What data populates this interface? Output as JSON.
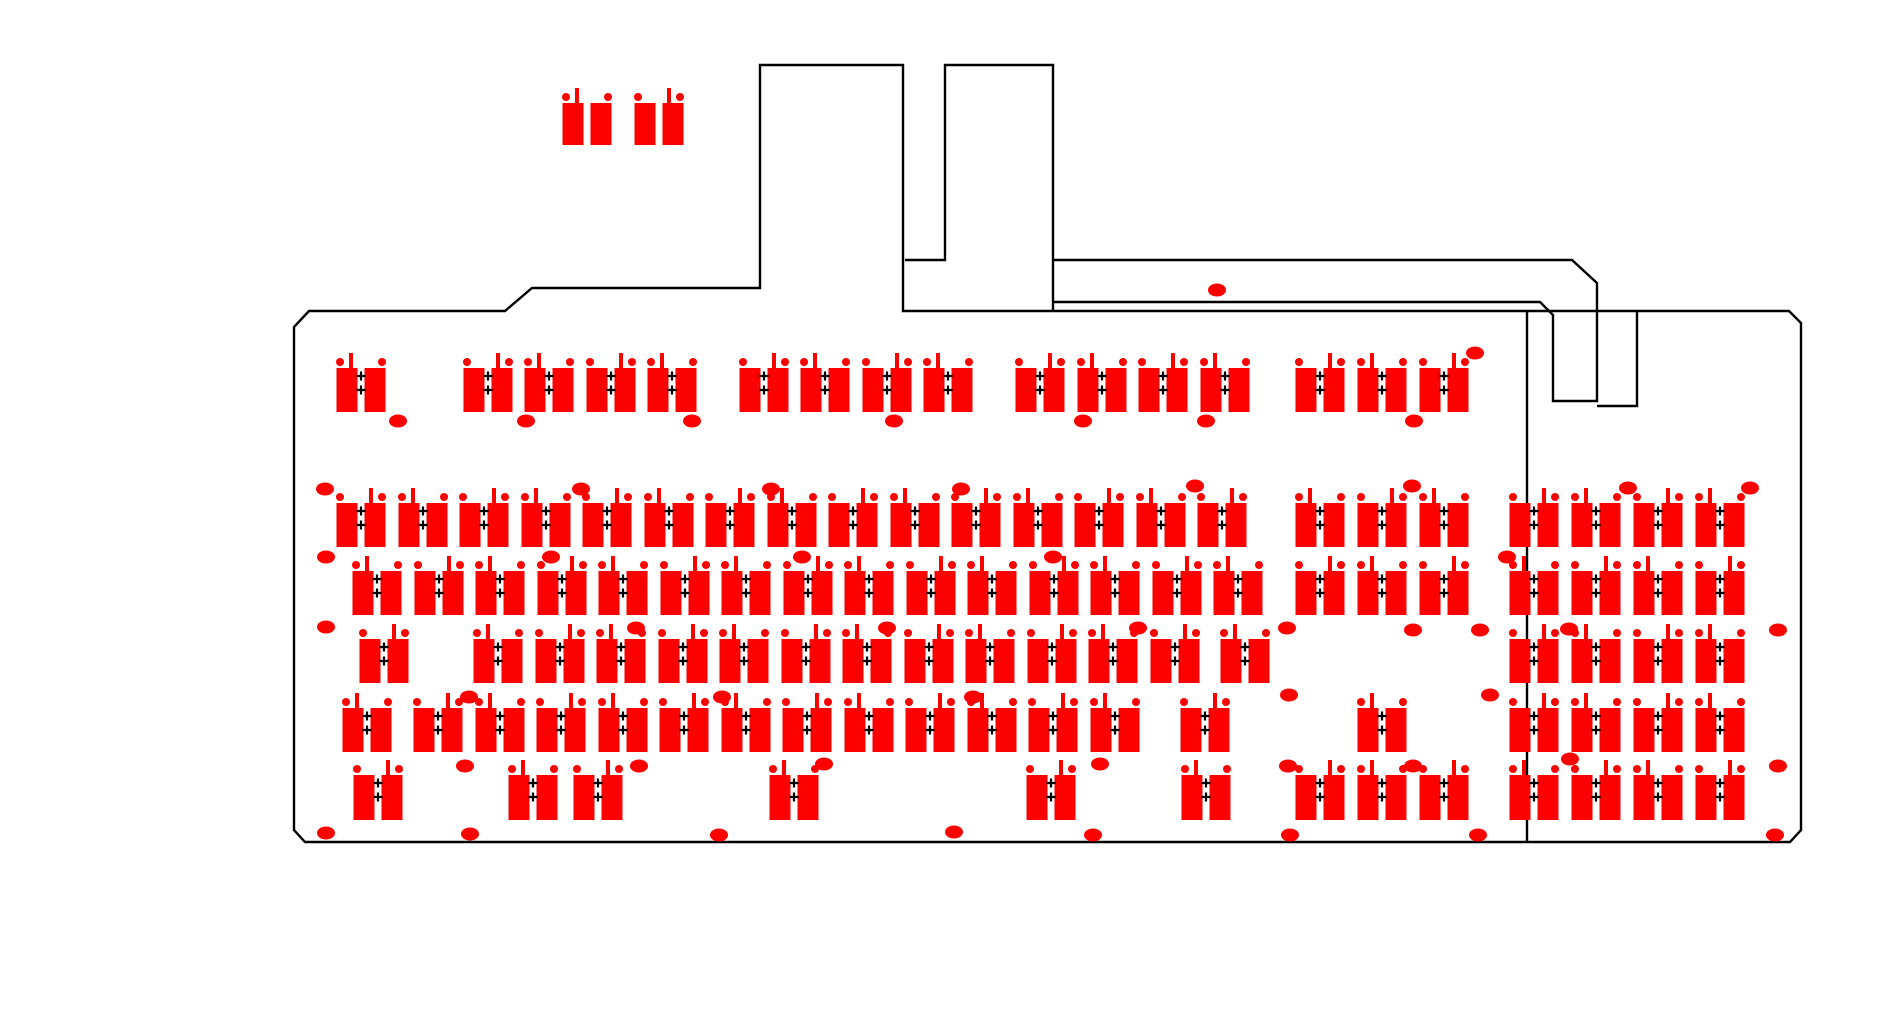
{
  "document": {
    "type": "keyboard-pcb-layout-drawing",
    "visible_text": "",
    "canvas": {
      "width": 1903,
      "height": 1026
    }
  },
  "colors": {
    "pad_red": "#fb0200",
    "outline_black": "#000000",
    "background": "#ffffff"
  },
  "footprint_geometry": {
    "rect_w": 21,
    "rect_h": 44,
    "rect_gap": 7,
    "dot_r": 4,
    "dot_dx": 21,
    "dot_dy": -6,
    "stub_w": 4,
    "stub_h": 17,
    "stub_dx": 10,
    "cross_size": 9,
    "cross_dy1": 8,
    "cross_dy2": 22,
    "hole_rx": 9,
    "hole_ry": 6.5
  },
  "key_rows": [
    {
      "name": "function-row",
      "y": 368,
      "h": 44,
      "crosses": true,
      "keys": [
        361,
        488,
        549,
        611,
        672,
        764,
        825,
        887,
        948,
        1040,
        1102,
        1163,
        1225,
        1320,
        1382,
        1444
      ]
    },
    {
      "name": "number-row",
      "y": 503,
      "h": 44,
      "crosses": true,
      "keys": [
        361,
        423,
        484,
        546,
        607,
        669,
        730,
        792,
        853,
        915,
        976,
        1038,
        1099,
        1161,
        1222,
        1320,
        1382,
        1444,
        1534,
        1596,
        1658,
        1720
      ]
    },
    {
      "name": "tab-row",
      "y": 571,
      "h": 44,
      "crosses": true,
      "keys": [
        377,
        439,
        500,
        562,
        623,
        685,
        746,
        808,
        869,
        931,
        992,
        1054,
        1115,
        1177,
        1238,
        1320,
        1382,
        1444,
        1534,
        1596,
        1658,
        1720
      ]
    },
    {
      "name": "home-row",
      "y": 639,
      "h": 44,
      "crosses": true,
      "keys": [
        384,
        498,
        560,
        621,
        683,
        744,
        806,
        867,
        929,
        990,
        1052,
        1113,
        1175,
        1245,
        1534,
        1596,
        1658,
        1720
      ]
    },
    {
      "name": "shift-row",
      "y": 708,
      "h": 44,
      "crosses": true,
      "keys": [
        367,
        438,
        500,
        561,
        623,
        684,
        746,
        807,
        869,
        930,
        992,
        1053,
        1115,
        1205,
        1382,
        1534,
        1596,
        1658,
        1720
      ]
    },
    {
      "name": "bottom-row",
      "y": 775,
      "h": 45,
      "crosses": true,
      "keys": [
        378,
        533,
        598,
        794,
        1051,
        1206,
        1320,
        1382,
        1444,
        1534,
        1596,
        1658,
        1720
      ]
    },
    {
      "name": "daughterboard-pads",
      "y": 103,
      "h": 42,
      "crosses": false,
      "keys": [
        587,
        659
      ]
    }
  ],
  "outline_paths": [
    {
      "name": "board-outline",
      "d": "M294,327 L309,311 L505,311 L532,288 L760,288 L760,65 L903,65 L903,311 L1789,311 L1801,323 L1801,830 L1790,842 L305,842 L294,830 Z"
    },
    {
      "name": "breakaway-tab-outline",
      "d": "M905,260 L945,260 L945,65 L1053,65 L1053,311"
    },
    {
      "name": "top-strip-outline",
      "d": "M1053,260 L1572,260 L1597,283 L1597,401 L1553,401 L1553,315 L1540,302 L1053,302"
    },
    {
      "name": "notch-outline",
      "d": "M1637,311 L1637,406 L1597,406"
    },
    {
      "name": "split-line",
      "d": "M1527,311 L1527,842"
    }
  ],
  "holes": [
    {
      "x": 1217,
      "y": 290
    },
    {
      "x": 1475,
      "y": 353
    },
    {
      "x": 398,
      "y": 421
    },
    {
      "x": 526,
      "y": 421
    },
    {
      "x": 692,
      "y": 421
    },
    {
      "x": 894,
      "y": 421
    },
    {
      "x": 1083,
      "y": 421
    },
    {
      "x": 1206,
      "y": 421
    },
    {
      "x": 1414,
      "y": 421
    },
    {
      "x": 325,
      "y": 489
    },
    {
      "x": 581,
      "y": 489
    },
    {
      "x": 771,
      "y": 489
    },
    {
      "x": 961,
      "y": 489
    },
    {
      "x": 1195,
      "y": 486
    },
    {
      "x": 1412,
      "y": 486
    },
    {
      "x": 1628,
      "y": 488
    },
    {
      "x": 1750,
      "y": 488
    },
    {
      "x": 326,
      "y": 557
    },
    {
      "x": 551,
      "y": 557
    },
    {
      "x": 802,
      "y": 557
    },
    {
      "x": 1053,
      "y": 557
    },
    {
      "x": 1507,
      "y": 557
    },
    {
      "x": 326,
      "y": 627
    },
    {
      "x": 636,
      "y": 628
    },
    {
      "x": 887,
      "y": 628
    },
    {
      "x": 1138,
      "y": 628
    },
    {
      "x": 1287,
      "y": 628
    },
    {
      "x": 1413,
      "y": 630
    },
    {
      "x": 1480,
      "y": 630
    },
    {
      "x": 1569,
      "y": 629
    },
    {
      "x": 1778,
      "y": 630
    },
    {
      "x": 469,
      "y": 697
    },
    {
      "x": 722,
      "y": 697
    },
    {
      "x": 973,
      "y": 697
    },
    {
      "x": 1289,
      "y": 695
    },
    {
      "x": 1490,
      "y": 695
    },
    {
      "x": 465,
      "y": 766
    },
    {
      "x": 639,
      "y": 766
    },
    {
      "x": 824,
      "y": 764
    },
    {
      "x": 1100,
      "y": 764
    },
    {
      "x": 1288,
      "y": 766
    },
    {
      "x": 1413,
      "y": 766
    },
    {
      "x": 1570,
      "y": 759
    },
    {
      "x": 1778,
      "y": 766
    },
    {
      "x": 326,
      "y": 833
    },
    {
      "x": 470,
      "y": 834
    },
    {
      "x": 719,
      "y": 835
    },
    {
      "x": 954,
      "y": 832
    },
    {
      "x": 1093,
      "y": 835
    },
    {
      "x": 1290,
      "y": 835
    },
    {
      "x": 1478,
      "y": 835
    },
    {
      "x": 1775,
      "y": 835
    }
  ]
}
